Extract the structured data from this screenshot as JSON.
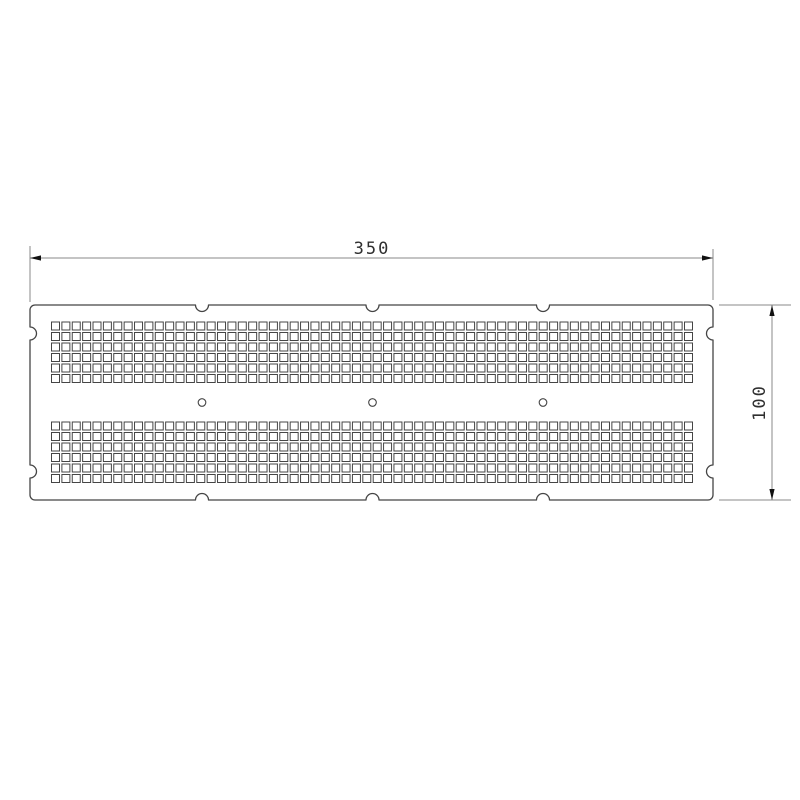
{
  "drawing": {
    "type": "technical-drawing",
    "part": "perforated-plate",
    "background_color": "#ffffff",
    "outline_color": "#454545",
    "dim_line_color": "#8a8a8a",
    "dim_text_color": "#2f2f2f",
    "arrow_color": "#111111",
    "dimensions": {
      "width": {
        "label": "350"
      },
      "height": {
        "label": "100"
      }
    },
    "features": {
      "perforation_bands": 2,
      "perforation_columns": 62,
      "perforation_rows_per_band": 6,
      "perforation_shape": "square",
      "mounting_holes": 3,
      "mounting_hole_shape": "circle",
      "edge_notches_top": 3,
      "edge_notches_bottom": 3,
      "edge_notches_left": 2,
      "edge_notches_right": 2
    }
  },
  "geometry": {
    "plate": {
      "x1": 30,
      "y1": 305,
      "x2": 713,
      "y2": 500,
      "corner_radius": 5,
      "notch_radius": 6.5
    },
    "squares": {
      "columns": 62,
      "rows_per_band": 6,
      "start_x": 51.5,
      "pitch_x": 10.377,
      "size": 8,
      "band_start_y": [
        322,
        422
      ],
      "pitch_y": 10.5
    },
    "circles": {
      "cx": [
        202,
        372.5,
        543
      ],
      "cy": 402.5,
      "r": 3.8
    },
    "notches": {
      "top_cx": [
        202,
        372.5,
        543
      ],
      "bottom_cx": [
        202,
        372.5,
        543
      ],
      "left_cy": [
        333.5,
        471.5
      ],
      "right_cy": [
        333.5,
        471.5
      ]
    },
    "dim_width": {
      "line_y": 258,
      "x1": 30,
      "x2": 713,
      "text_x": 372,
      "text_y": 254,
      "ext_left": [
        246,
        302
      ],
      "ext_right": [
        249,
        300
      ]
    },
    "dim_height": {
      "line_x": 772,
      "y1": 305,
      "y2": 500,
      "text_x": 765,
      "text_y": 402.5,
      "ext_x1": 719,
      "ext_x2": 791
    }
  }
}
